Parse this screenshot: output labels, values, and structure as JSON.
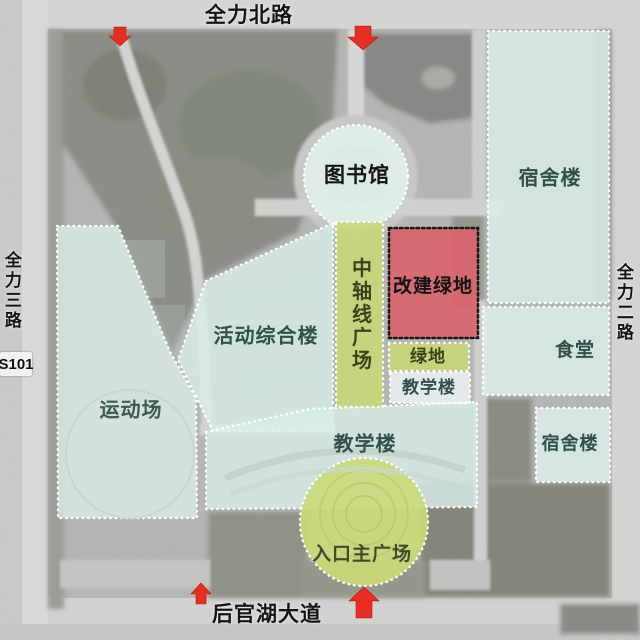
{
  "map": {
    "title": "campus-master-plan-satellite-overlay",
    "roads": {
      "north": "全力北路",
      "south": "后官湖大道",
      "west": "全力三路",
      "east": "全力二路",
      "highway_badge": "S101"
    },
    "zones": {
      "library": {
        "label": "图书馆",
        "color": "#d8ece7"
      },
      "dorm_right": {
        "label": "宿舍楼",
        "color": "#cfe9e2"
      },
      "central_axis_plaza": {
        "label": "中轴线广场",
        "color": "#b6ca5f"
      },
      "rebuilt_green": {
        "label": "改建绿地",
        "color": "#cb5257"
      },
      "green_strip": {
        "label": "绿地",
        "color": "#b6ca5f"
      },
      "teaching_small": {
        "label": "教学楼",
        "color": "#e8eef1"
      },
      "canteen": {
        "label": "食堂",
        "color": "#d3ebe5"
      },
      "dorm_small": {
        "label": "宿舍楼",
        "color": "#d3ebe5"
      },
      "activity_complex": {
        "label": "活动综合楼",
        "color": "#cde8e1"
      },
      "sports_field": {
        "label": "运动场",
        "color": "#cfe3db"
      },
      "teaching_main": {
        "label": "教学楼",
        "color": "#cde8e1"
      },
      "entrance_plaza": {
        "label": "入口主广场",
        "color": "#b9cf5e"
      }
    },
    "markers": {
      "arrow_color": "#e1251b",
      "entrance_arrows": [
        "north-west",
        "north-center",
        "south-west",
        "south-center"
      ]
    }
  }
}
